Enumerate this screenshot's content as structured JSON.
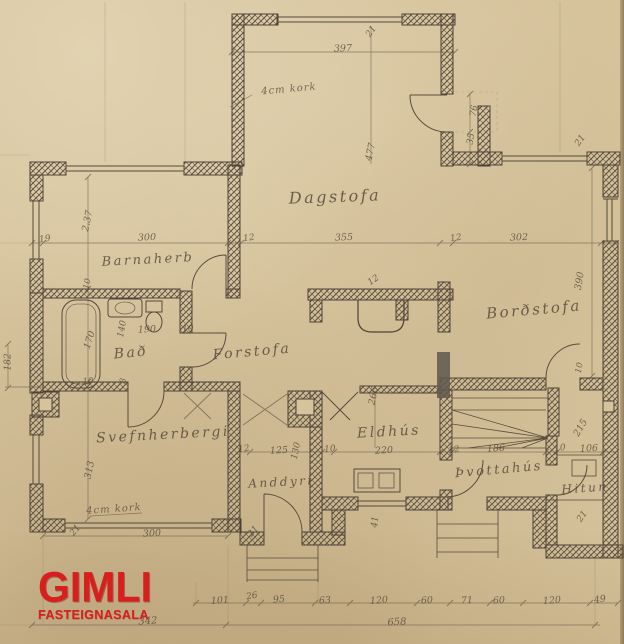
{
  "watermark": {
    "brand": "GIMLI",
    "subtitle": "FASTEIGNASALA",
    "color": "#d91e1e"
  },
  "colors": {
    "paper": "#d6c39c",
    "wall_ink": "#4e4236",
    "pencil": "#584a39",
    "logo_red": "#d91e1e"
  },
  "labels": [
    {
      "text": "Dagstofa",
      "x": 335,
      "y": 197,
      "rot": -2,
      "cls": "room",
      "size": 16
    },
    {
      "text": "Barnaherb",
      "x": 148,
      "y": 260,
      "rot": -3,
      "cls": "room",
      "size": 13
    },
    {
      "text": "Bað",
      "x": 131,
      "y": 353,
      "rot": -5,
      "cls": "room",
      "size": 14
    },
    {
      "text": "Forstofa",
      "x": 252,
      "y": 352,
      "rot": -5,
      "cls": "room",
      "size": 14
    },
    {
      "text": "Borðstofa",
      "x": 534,
      "y": 310,
      "rot": -5,
      "cls": "room",
      "size": 15
    },
    {
      "text": "Svefnherbergi",
      "x": 163,
      "y": 435,
      "rot": -3,
      "cls": "room",
      "size": 14
    },
    {
      "text": "Eldhús",
      "x": 389,
      "y": 432,
      "rot": -3,
      "cls": "room",
      "size": 14
    },
    {
      "text": "Anddyri",
      "x": 281,
      "y": 482,
      "rot": -3,
      "cls": "room",
      "size": 12
    },
    {
      "text": "Þvottahús",
      "x": 499,
      "y": 470,
      "rot": -5,
      "cls": "room",
      "size": 13
    },
    {
      "text": "Hitun",
      "x": 585,
      "y": 488,
      "rot": -4,
      "cls": "room",
      "size": 12
    },
    {
      "text": "4cm kork",
      "x": 289,
      "y": 90,
      "rot": -5,
      "cls": "note",
      "size": 10
    },
    {
      "text": "4cm kork",
      "x": 114,
      "y": 510,
      "rot": -4,
      "cls": "note",
      "size": 10
    },
    {
      "text": "397",
      "x": 343,
      "y": 49,
      "rot": -2,
      "cls": "dim",
      "size": 9.5
    },
    {
      "text": "21",
      "x": 372,
      "y": 32,
      "rot": -55,
      "cls": "dim",
      "size": 9
    },
    {
      "text": "477",
      "x": 371,
      "y": 152,
      "rot": -78,
      "cls": "dim",
      "size": 9.5
    },
    {
      "text": "76",
      "x": 475,
      "y": 111,
      "rot": -80,
      "cls": "dim",
      "size": 9
    },
    {
      "text": "35",
      "x": 472,
      "y": 139,
      "rot": -80,
      "cls": "dim",
      "size": 9
    },
    {
      "text": "21",
      "x": 581,
      "y": 141,
      "rot": -55,
      "cls": "dim",
      "size": 9
    },
    {
      "text": "19",
      "x": 45,
      "y": 240,
      "rot": -8,
      "cls": "dim",
      "size": 9
    },
    {
      "text": "300",
      "x": 147,
      "y": 238,
      "rot": -2,
      "cls": "dim",
      "size": 9.5
    },
    {
      "text": "12",
      "x": 249,
      "y": 239,
      "rot": -8,
      "cls": "dim",
      "size": 9
    },
    {
      "text": "355",
      "x": 344,
      "y": 238,
      "rot": -2,
      "cls": "dim",
      "size": 9.5
    },
    {
      "text": "12",
      "x": 456,
      "y": 239,
      "rot": -8,
      "cls": "dim",
      "size": 9
    },
    {
      "text": "302",
      "x": 519,
      "y": 238,
      "rot": -2,
      "cls": "dim",
      "size": 9.5
    },
    {
      "text": "2.37",
      "x": 88,
      "y": 221,
      "rot": -78,
      "cls": "dim",
      "size": 9.5
    },
    {
      "text": "390",
      "x": 580,
      "y": 281,
      "rot": -80,
      "cls": "dim",
      "size": 9.5
    },
    {
      "text": "170",
      "x": 90,
      "y": 340,
      "rot": -72,
      "cls": "dim",
      "size": 9.5
    },
    {
      "text": "140",
      "x": 123,
      "y": 329,
      "rot": -80,
      "cls": "dim",
      "size": 9
    },
    {
      "text": "190",
      "x": 147,
      "y": 330,
      "rot": -3,
      "cls": "dim",
      "size": 9.5
    },
    {
      "text": "10",
      "x": 188,
      "y": 330,
      "rot": -5,
      "cls": "dim",
      "size": 9
    },
    {
      "text": "10",
      "x": 88,
      "y": 284,
      "rot": -80,
      "cls": "dim",
      "size": 8.5
    },
    {
      "text": "10",
      "x": 88,
      "y": 382,
      "rot": -5,
      "cls": "dim",
      "size": 8.5
    },
    {
      "text": "8",
      "x": 124,
      "y": 381,
      "rot": -80,
      "cls": "dim",
      "size": 8.5
    },
    {
      "text": "182",
      "x": 9,
      "y": 362,
      "rot": -90,
      "cls": "dim",
      "size": 9
    },
    {
      "text": "313",
      "x": 90,
      "y": 470,
      "rot": -78,
      "cls": "dim",
      "size": 9.5
    },
    {
      "text": "300",
      "x": 152,
      "y": 534,
      "rot": -3,
      "cls": "dim",
      "size": 9.5
    },
    {
      "text": "21",
      "x": 76,
      "y": 531,
      "rot": -50,
      "cls": "dim",
      "size": 9
    },
    {
      "text": "21",
      "x": 254,
      "y": 532,
      "rot": -50,
      "cls": "dim",
      "size": 9
    },
    {
      "text": "266",
      "x": 374,
      "y": 396,
      "rot": -78,
      "cls": "dim",
      "size": 9.5
    },
    {
      "text": "12",
      "x": 244,
      "y": 450,
      "rot": -8,
      "cls": "dim",
      "size": 9
    },
    {
      "text": "125",
      "x": 279,
      "y": 451,
      "rot": -3,
      "cls": "dim",
      "size": 9.5
    },
    {
      "text": "130",
      "x": 297,
      "y": 451,
      "rot": -78,
      "cls": "dim",
      "size": 9
    },
    {
      "text": "10",
      "x": 330,
      "y": 450,
      "rot": -5,
      "cls": "dim",
      "size": 9
    },
    {
      "text": "220",
      "x": 384,
      "y": 451,
      "rot": -3,
      "cls": "dim",
      "size": 9.5
    },
    {
      "text": "12",
      "x": 454,
      "y": 451,
      "rot": -8,
      "cls": "dim",
      "size": 9
    },
    {
      "text": "186",
      "x": 496,
      "y": 449,
      "rot": -3,
      "cls": "dim",
      "size": 9.5
    },
    {
      "text": "10",
      "x": 560,
      "y": 449,
      "rot": -5,
      "cls": "dim",
      "size": 9
    },
    {
      "text": "106",
      "x": 589,
      "y": 449,
      "rot": -3,
      "cls": "dim",
      "size": 9.5
    },
    {
      "text": "215",
      "x": 581,
      "y": 428,
      "rot": -60,
      "cls": "dim",
      "size": 9.5
    },
    {
      "text": "41",
      "x": 376,
      "y": 522,
      "rot": -85,
      "cls": "dim",
      "size": 9
    },
    {
      "text": "21",
      "x": 583,
      "y": 517,
      "rot": -55,
      "cls": "dim",
      "size": 9
    },
    {
      "text": "12",
      "x": 374,
      "y": 281,
      "rot": -35,
      "cls": "dim",
      "size": 9
    },
    {
      "text": "10",
      "x": 580,
      "y": 368,
      "rot": -80,
      "cls": "dim",
      "size": 8.5
    },
    {
      "text": "101",
      "x": 220,
      "y": 601,
      "rot": -4,
      "cls": "dim",
      "size": 9.5
    },
    {
      "text": "26",
      "x": 252,
      "y": 597,
      "rot": -10,
      "cls": "dim",
      "size": 9
    },
    {
      "text": "95",
      "x": 279,
      "y": 600,
      "rot": -4,
      "cls": "dim",
      "size": 9.5
    },
    {
      "text": "63",
      "x": 325,
      "y": 601,
      "rot": -4,
      "cls": "dim",
      "size": 9.5
    },
    {
      "text": "120",
      "x": 379,
      "y": 601,
      "rot": -4,
      "cls": "dim",
      "size": 9.5
    },
    {
      "text": "60",
      "x": 427,
      "y": 601,
      "rot": -4,
      "cls": "dim",
      "size": 9.5
    },
    {
      "text": "71",
      "x": 467,
      "y": 601,
      "rot": -4,
      "cls": "dim",
      "size": 9.5
    },
    {
      "text": "60",
      "x": 499,
      "y": 601,
      "rot": -4,
      "cls": "dim",
      "size": 9.5
    },
    {
      "text": "120",
      "x": 552,
      "y": 601,
      "rot": -4,
      "cls": "dim",
      "size": 9.5
    },
    {
      "text": "49",
      "x": 600,
      "y": 600,
      "rot": -8,
      "cls": "dim",
      "size": 9.5
    },
    {
      "text": "342",
      "x": 148,
      "y": 622,
      "rot": -4,
      "cls": "dim",
      "size": 10
    },
    {
      "text": "658",
      "x": 397,
      "y": 623,
      "rot": -3,
      "cls": "dim",
      "size": 10
    }
  ]
}
